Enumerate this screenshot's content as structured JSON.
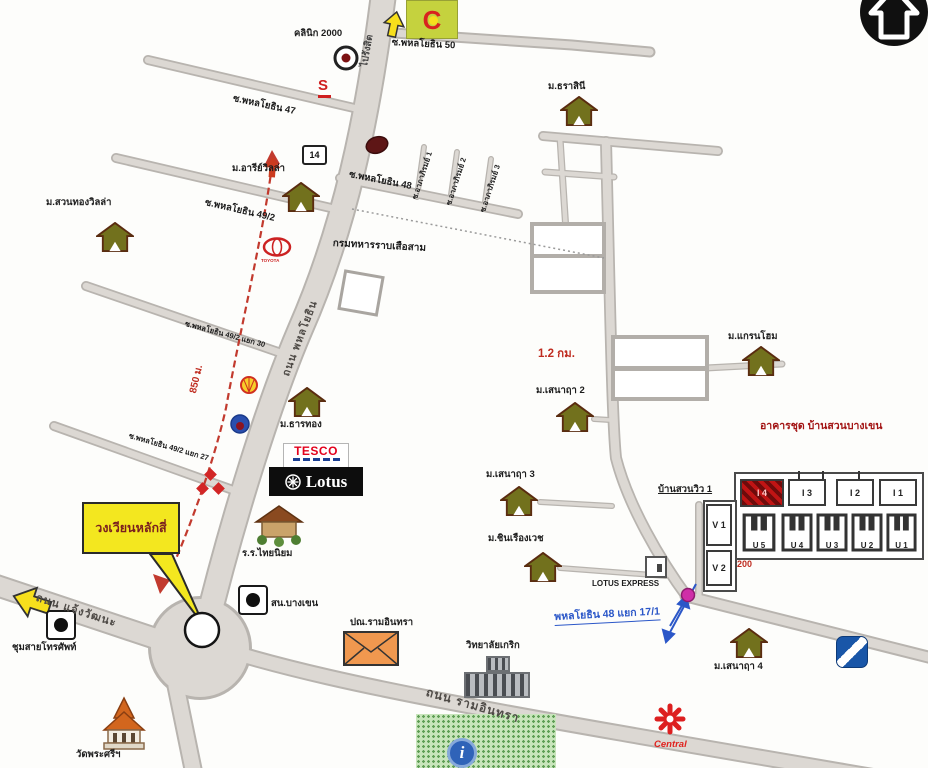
{
  "nav": {
    "home_button": "home"
  },
  "roads": {
    "phahonyothin": "ถนน พหลโยธิน",
    "to_rangsit": "ไปรังสิต",
    "chaeng_watthana": "ถนน แจ้งวัฒนะ",
    "ram_intra": "ถนน รามอินทรา",
    "soi_50": "ซ.พหลโยธิน 50",
    "soi_47": "ซ.พหลโยธิน 47",
    "soi_49_2": "ซ.พหลโยธิน 49/2",
    "soi_49_2_30": "ซ.พหลโยธิน 49/2 แยก 30",
    "soi_49_2_27": "ซ.พหลโยธิน 49/2 แยก 27",
    "soi_48": "ซ.พหลโยธิน 48",
    "soi_48_17_1": "พหลโยธิน 48 แยก 17/1",
    "soi_apha_1": "ซ.อาภาภิรมย์ 1",
    "soi_apha_2": "ซ.อาภาภิรมย์ 2",
    "soi_apha_3": "ซ.อาภาภิรมย์ 3"
  },
  "distances": {
    "route_850m": "850 ม.",
    "route_1_2km": "1.2 กม.",
    "dist_200": "200"
  },
  "callout": {
    "lak_si_roundabout": "วงเวียนหลักสี่"
  },
  "villages": [
    {
      "label": "ม.สวนทองวิลล่า"
    },
    {
      "label": "ม.อารีย์วิลล่า"
    },
    {
      "label": "ม.ธราสินี"
    },
    {
      "label": "ม.ธารทอง"
    },
    {
      "label": "ม.เสนาฤา 2"
    },
    {
      "label": "ม.เสนาฤา 3"
    },
    {
      "label": "ม.ชินเรืองเวช"
    },
    {
      "label": "ม.แกรนโฮม"
    },
    {
      "label": "ม.เสนาฤา 4"
    }
  ],
  "places": {
    "clinic_2000": "คลินิก 2000",
    "infantry_regiment": "กรมทหารราบเสือสาม",
    "thai_niyom_school": "ร.ร.ไทยนิยม",
    "bangkhen_police": "สน.บางเขน",
    "telephone_exchange": "ชุมสายโทรศัพท์",
    "wat_phra_si": "วัดพระศรีฯ",
    "ram_intra_post_office": "ปณ.รามอินทรา",
    "krirk_college": "วิทยาลัยเกริก",
    "lotus_express": "LOTUS EXPRESS"
  },
  "brands": {
    "big_c": "C",
    "tesco": "TESCO",
    "lotus": "Lotus",
    "central": "Central",
    "toyota": "TOYOTA",
    "sign_14": "14",
    "suzuki_s": "S",
    "info_i": "i"
  },
  "condo": {
    "title": "อาคารชุด บ้านสวนบางเขน",
    "baan_suan_view": "บ้านสวนวิว 1",
    "i_buildings": [
      {
        "label": "I 4"
      },
      {
        "label": "I 3"
      },
      {
        "label": "I 2"
      },
      {
        "label": "I 1"
      }
    ],
    "u_buildings": [
      {
        "label": "U 5"
      },
      {
        "label": "U 4"
      },
      {
        "label": "U 3"
      },
      {
        "label": "U 2"
      },
      {
        "label": "U 1"
      }
    ],
    "v_buildings": [
      {
        "label": "V 1"
      },
      {
        "label": "V 2"
      }
    ]
  },
  "colors": {
    "route_red": "#c23a2e",
    "callout_yellow": "#f3e71f",
    "link_blue": "#2b57c8",
    "condo_red": "#a31515",
    "road_gray": "#dcd8d3"
  }
}
